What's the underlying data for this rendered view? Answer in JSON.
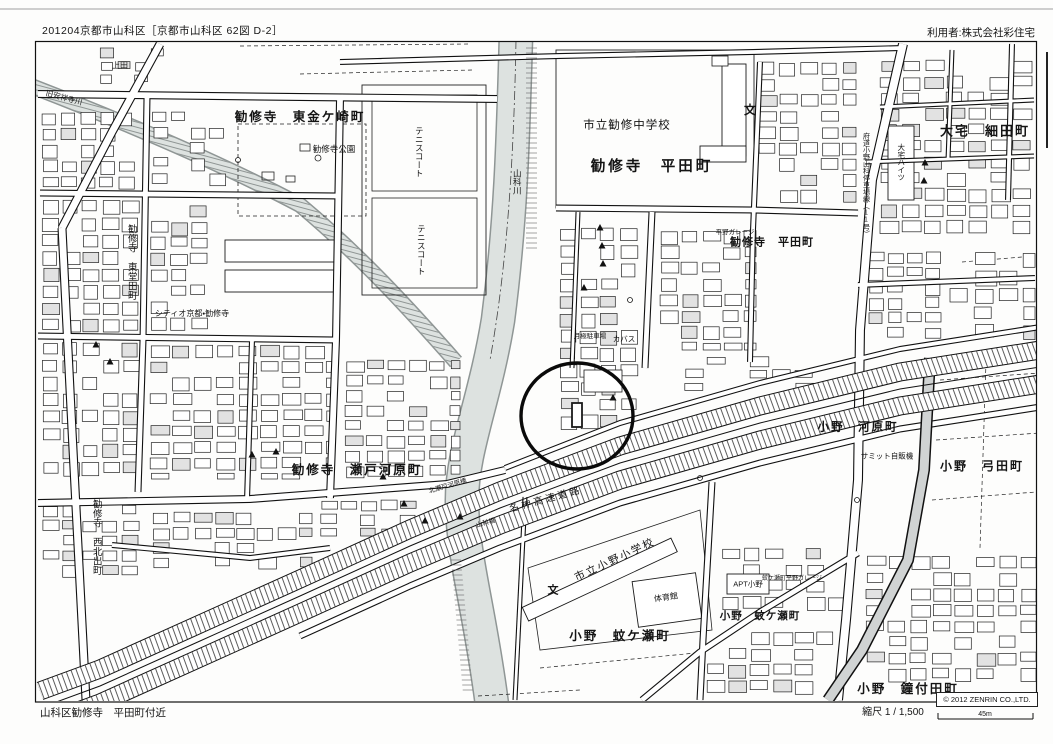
{
  "page": {
    "title_left": "201204京都市山科区［京都市山科区 62図 D-2］",
    "title_right": "利用者:株式会社彩住宅"
  },
  "footer": {
    "area_label": "山科区勧修寺　平田町付近",
    "scale_label": "縮尺 1 / 1,500",
    "scale_distance": "45m",
    "copyright": "© 2012 ZENRIN CO.,LTD."
  },
  "map": {
    "labels": {
      "higashikanegasaki": "勧修寺　東金ケ崎町",
      "kanshuji_park": "勧修寺公園",
      "tennis_court": "テニスコート",
      "chugakko": "市立勧修中学校",
      "hirata_main": "勧修寺　平田町",
      "oyake_hosoda": "大宅　細田町",
      "hirata_right": "勧修寺　平田町",
      "hirano_garage": "平野ガレージ",
      "oyake_heights": "大宅ハイツ",
      "fudo_road": "府道小野山科停車場線（11号）",
      "ono_kawara": "小野　河原町",
      "summit_vending": "サミット自販機",
      "ono_yumita": "小野　弓田町",
      "setogawara": "勧修寺　瀬戸河原町",
      "kitaseto_bridge": "北瀬戸河原橋",
      "yamashina_bridge": "山科橋",
      "meishin": "名神高速道路",
      "yamashina_river": "山科川",
      "anshoji_river": "旧安祥寺川",
      "ueda": "上田",
      "citio": "シティオ京都・勧修寺",
      "higashidoda": "勧修寺　東堂田町",
      "nishikitade": "勧修寺　西北出町",
      "tsukigime_parking": "月極駐車場",
      "kabasu": "カバス",
      "ono_shogakko": "市立小野小学校",
      "taiikukan": "体育館",
      "ono_kagase": "小野　蚊ケ瀬町",
      "kagase_garage": "蚊ケ瀬町平野ガレージ",
      "apt_ono": "APT小野",
      "kanetsukida": "小野　鐘付田町",
      "school_symbol": "文"
    },
    "colors": {
      "river": "#dde2e0",
      "river_edge": "#8f9695",
      "road_major_fill": "#d0d3d3",
      "ink": "#1a1a1a"
    }
  }
}
